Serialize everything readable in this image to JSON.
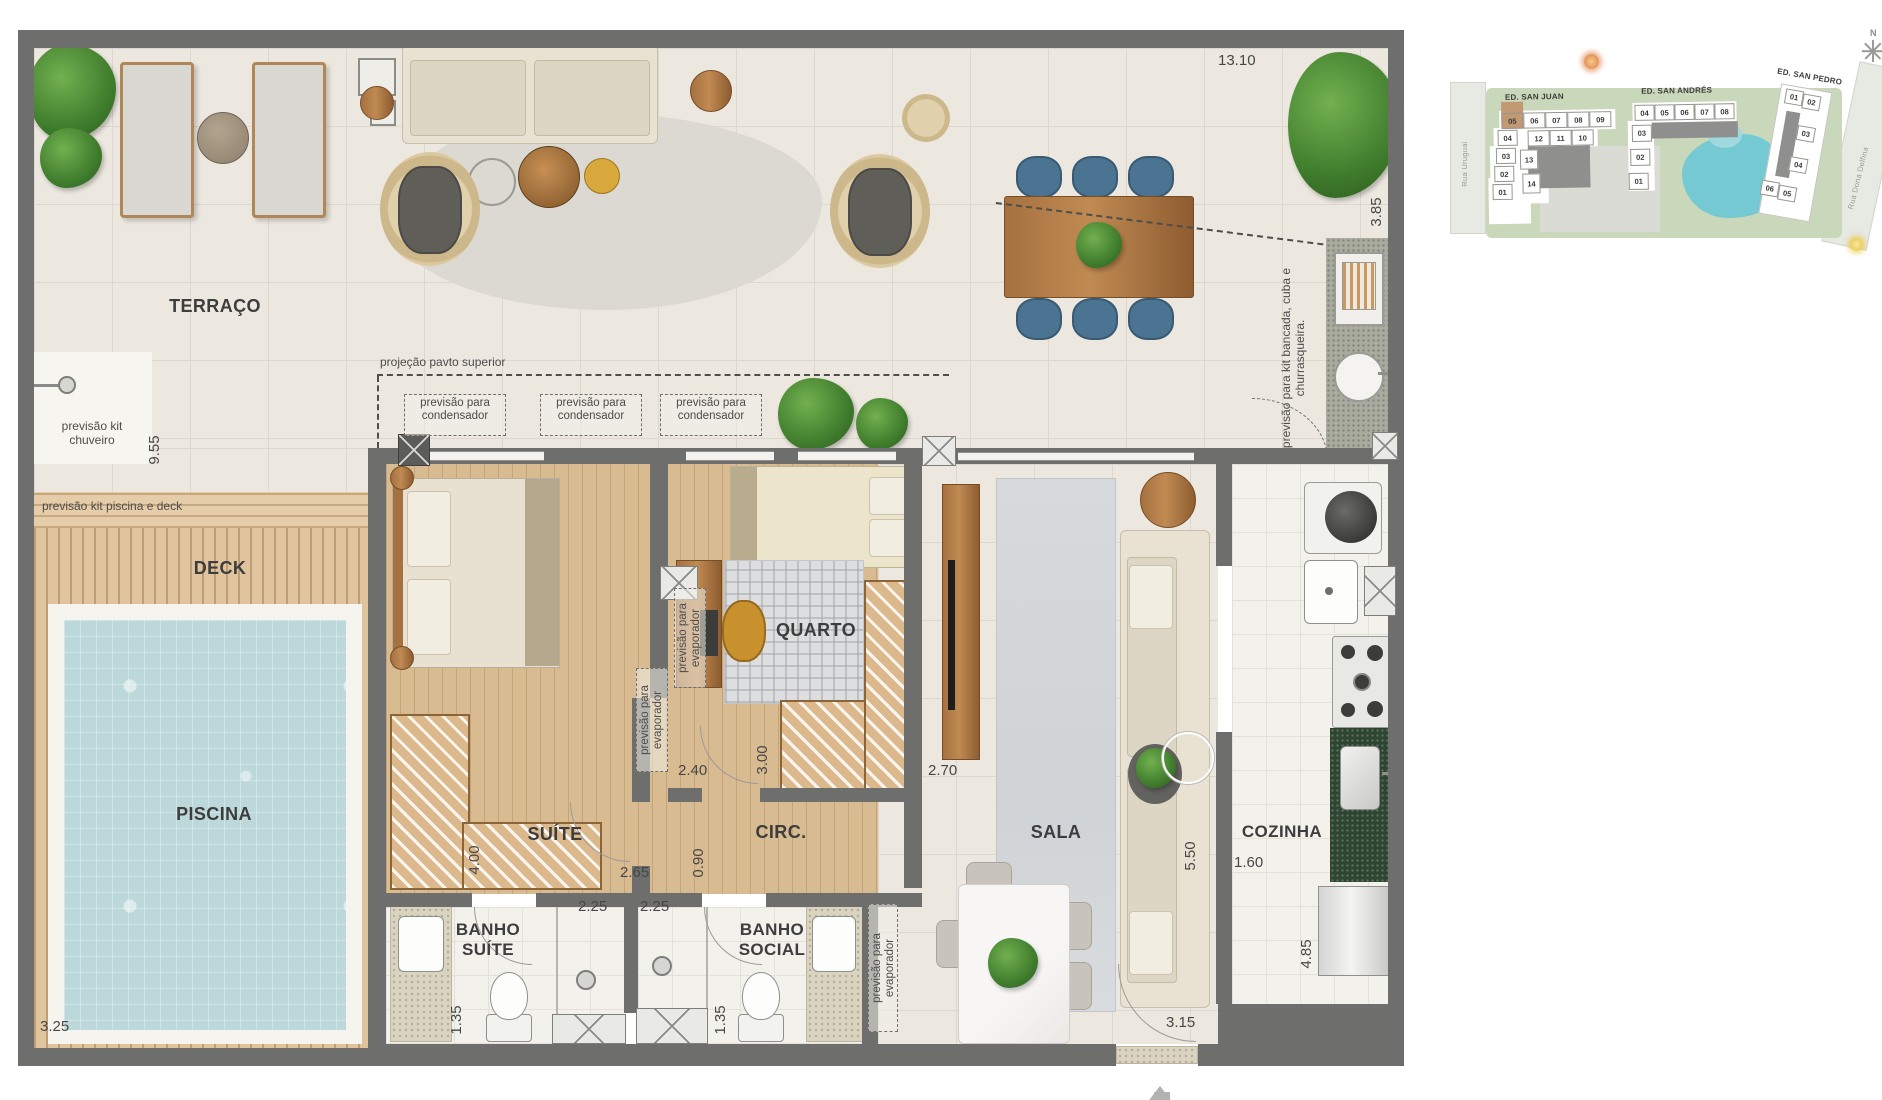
{
  "plan": {
    "rooms": {
      "terraco": "TERRAÇO",
      "deck": "DECK",
      "piscina": "PISCINA",
      "suite": "SUÍTE",
      "quarto": "QUARTO",
      "circ": "CIRC.",
      "sala": "SALA",
      "cozinha": "COZINHA",
      "banho_suite": "BANHO SUÍTE",
      "banho_social": "BANHO SOCIAL"
    },
    "notes": {
      "chuveiro": "previsão kit chuveiro",
      "piscina_deck": "previsão kit piscina e deck",
      "projecao": "projeção pavto superior",
      "condensador": "previsão para condensador",
      "evaporador": "previsão para evaporador",
      "bancada": "previsão para kit bancada, cuba e churrasqueira."
    },
    "dims": {
      "t_top": "13.10",
      "t_right": "3.85",
      "t_left": "9.55",
      "deck_b": "3.25",
      "suite_w": "4.00",
      "suite_top": "2.40",
      "quarto_side": "3.00",
      "quarto_b": "2.70",
      "circ_top": "2.65",
      "circ_w": "0.90",
      "bs_w": "2.25",
      "bso_w": "2.25",
      "bs_h": "1.35",
      "bso_h": "1.35",
      "sala_h": "5.50",
      "coz_top": "1.60",
      "coz_h": "4.85",
      "entry": "3.15"
    }
  },
  "sitemap": {
    "buildings": [
      {
        "name": "ED. SAN JUAN",
        "units": [
          "05",
          "06",
          "07",
          "08",
          "09",
          "04",
          "12",
          "11",
          "10",
          "03",
          "13",
          "02",
          "14",
          "01"
        ],
        "highlighted_unit": "05"
      },
      {
        "name": "ED. SAN ANDRÉS",
        "units": [
          "04",
          "05",
          "06",
          "07",
          "08",
          "03",
          "02",
          "01"
        ]
      },
      {
        "name": "ED. SAN PEDRO",
        "units": [
          "01",
          "02",
          "03",
          "04",
          "06",
          "05"
        ]
      }
    ],
    "streets": [
      "Rua Uruguai",
      "Rua Dona Delfina"
    ],
    "compass": "N"
  },
  "colors": {
    "wall": "#6e6e6c",
    "highlight_unit": "#c19a73",
    "pool_water": "#bdd8da",
    "sitemap_pool": "#74c9d2"
  }
}
